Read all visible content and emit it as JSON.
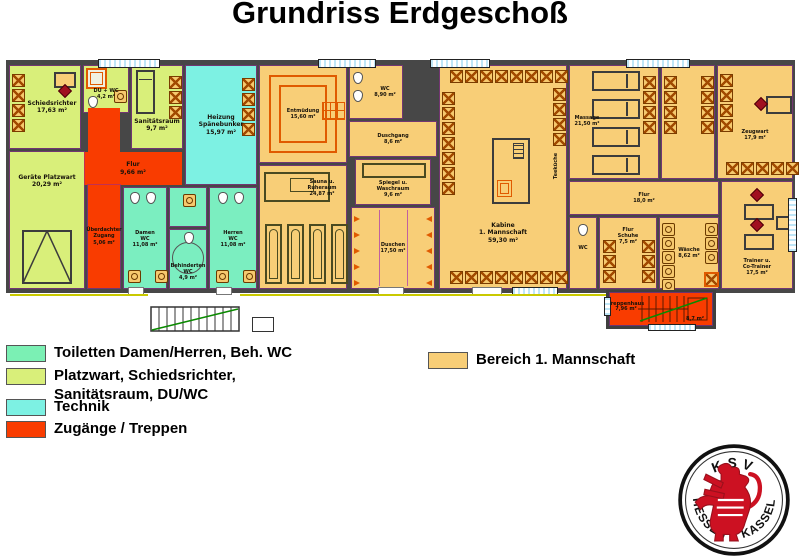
{
  "title": "Grundriss Erdgeschoß",
  "plan": {
    "rooms": {
      "schiedsrichter": {
        "name": "Schiedsrichter",
        "area": "17,63 m²"
      },
      "du_wc": {
        "name": "DU + WC",
        "area": "4,2 m²"
      },
      "sanitaetsraum": {
        "name": "Sanitätsraum",
        "area": "9,7 m²"
      },
      "flur": {
        "name": "Flur",
        "area": "9,66 m²"
      },
      "zugang": {
        "name": "Überdachter",
        "name2": "Zugang",
        "area": "5,06 m²"
      },
      "platzwart": {
        "name": "Geräte Platzwart",
        "area": "20,29 m²"
      },
      "heizung": {
        "name": "Heizung",
        "name2": "Spänebunker",
        "area": "15,97 m²"
      },
      "damen_wc": {
        "name": "Damen",
        "name2": "WC",
        "area": "11,08 m²"
      },
      "beh_wc": {
        "name": "Behinderten",
        "name2": "WC",
        "area": "4,9 m²"
      },
      "herren_wc": {
        "name": "Herren",
        "name2": "WC",
        "area": "11,08 m²"
      },
      "entmuedung": {
        "name": "Entmüdung",
        "area": "15,60 m²"
      },
      "sauna": {
        "name": "Sauna u.",
        "name2": "Ruheraum",
        "area": "24,87 m²"
      },
      "wc_mannschaft": {
        "name": "WC",
        "area": "8,90 m²"
      },
      "duschgang": {
        "name": "Duschgang",
        "area": "8,6 m²"
      },
      "spiegel": {
        "name": "Spiegel u.",
        "name2": "Waschraum",
        "area": "9,6 m²"
      },
      "duschen": {
        "name": "Duschen",
        "area": "17,50 m²"
      },
      "kabine": {
        "name": "Kabine",
        "name2": "1. Mannschaft",
        "area": "59,30 m²"
      },
      "teekueche": {
        "name": "Teeküche"
      },
      "massage": {
        "name": "Massage",
        "area": "21,50 m²"
      },
      "zeugwart": {
        "name": "Zeugwart",
        "area": "17,9 m²"
      },
      "flur2": {
        "name": "Flur",
        "area": "18,0 m²"
      },
      "wc2": {
        "name": "WC"
      },
      "schuhe": {
        "name": "Flur",
        "name2": "Schuhe",
        "area": "7,5 m²"
      },
      "waesche": {
        "name": "Wäsche",
        "area": "8,62 m²"
      },
      "trainer": {
        "name": "Trainer u.",
        "name2": "Co-Trainer",
        "area": "17,5 m²"
      },
      "treppenhaus": {
        "name": "Treppenhaus",
        "area": "7,96 m²",
        "area2": "8,7 m²"
      }
    }
  },
  "legend": {
    "items": [
      {
        "label": "Toiletten Damen/Herren, Beh. WC",
        "color": "#7bf0b4"
      },
      {
        "label": "Platzwart, Schiedsrichter, Sanitätsraum, DU/WC",
        "color": "#d9ef7a"
      },
      {
        "label": "Technik",
        "color": "#7df1e3"
      },
      {
        "label": "Zugänge / Treppen",
        "color": "#f93c00"
      }
    ],
    "bereich": {
      "label": "Bereich 1. Mannschaft",
      "color": "#f8ce77"
    }
  },
  "logo": {
    "top": "KSV",
    "left": "HESSEN",
    "right": "KASSEL"
  }
}
